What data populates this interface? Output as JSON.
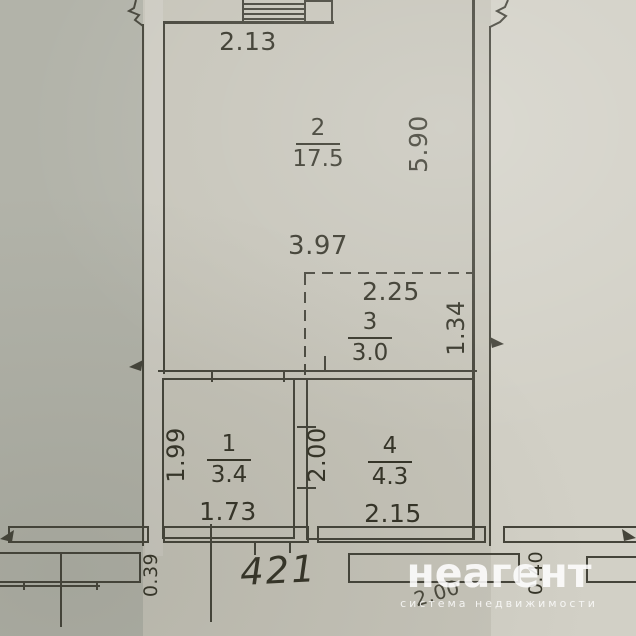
{
  "rooms": {
    "room1": {
      "number": "1",
      "area": "3.4"
    },
    "room2": {
      "number": "2",
      "area": "17.5"
    },
    "room3": {
      "number": "3",
      "area": "3.0"
    },
    "room4": {
      "number": "4",
      "area": "4.3"
    }
  },
  "dims": {
    "stair_width": "2.13",
    "room2_depth": "5.90",
    "room2_width": "3.97",
    "room3_width": "2.25",
    "room3_depth": "1.34",
    "room1_depth": "1.99",
    "room1_width": "1.73",
    "opening_width": "2.00",
    "room4_width": "2.15",
    "balcony_left_width": "0.39",
    "balcony_right_width": "0.40",
    "balcony_length": "2.00",
    "plan_number": "421"
  },
  "watermark": {
    "brand": "неагент",
    "tagline": "система недвижимости"
  },
  "colors": {
    "paper": "#c6c4b9",
    "paper_left": "#b2b3a9",
    "paper_right": "#d2d0c6",
    "line": "#45443a",
    "text": "#353428",
    "wm": "#ffffff"
  }
}
